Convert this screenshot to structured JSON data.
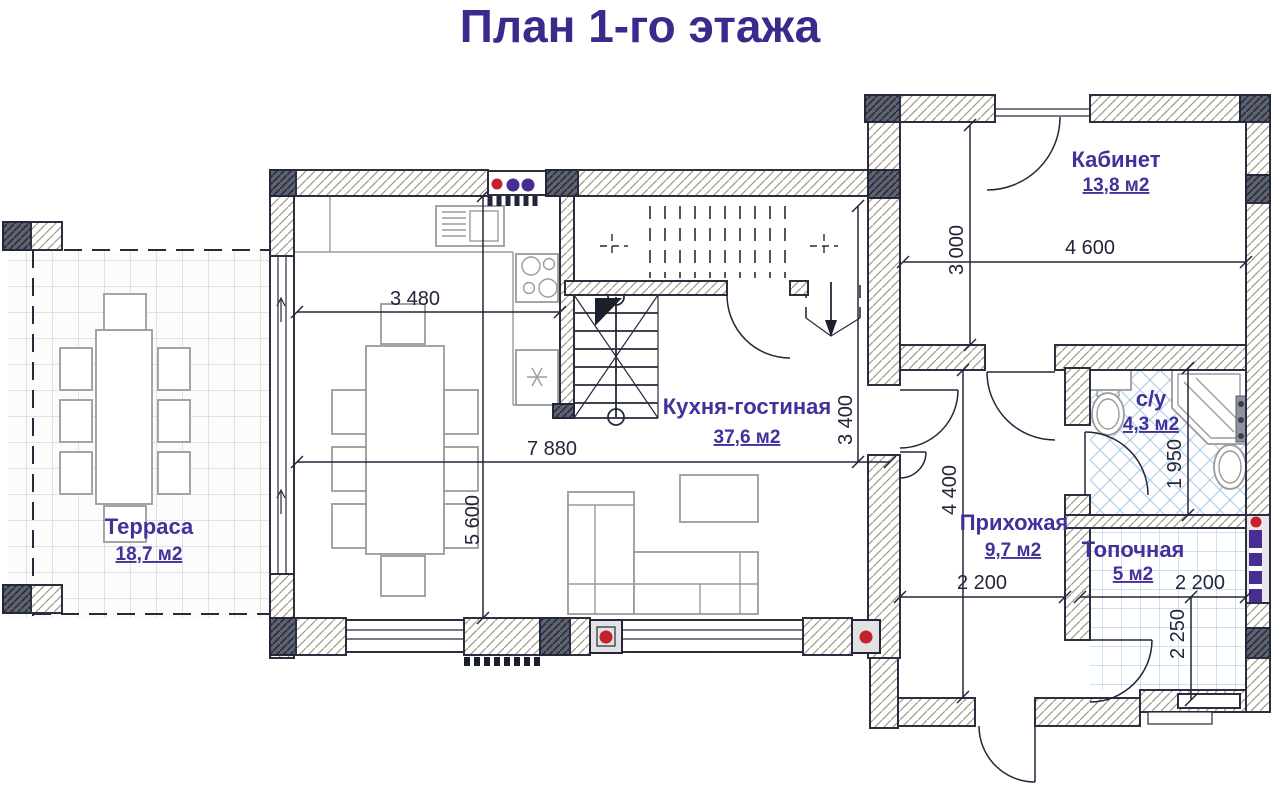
{
  "title": "План 1-го этажа",
  "rooms": {
    "terrace": {
      "name": "Терраса",
      "area": "18,7 м2"
    },
    "kitchen_living": {
      "name": "Кухня-гостиная",
      "area": "37,6 м2"
    },
    "office": {
      "name": "Кабинет",
      "area": "13,8 м2"
    },
    "bathroom": {
      "name": "с/у",
      "area": "4,3 м2"
    },
    "hallway": {
      "name": "Прихожая",
      "area": "9,7 м2"
    },
    "boiler": {
      "name": "Топочная",
      "area": "5 м2"
    }
  },
  "dimensions": {
    "kitchen_width": "3 480",
    "living_total_width": "7 880",
    "living_height": "5 600",
    "kitchen_depth": "3 400",
    "office_depth": "3 000",
    "office_width": "4 600",
    "bathroom_depth": "1 950",
    "hallway_depth": "4 400",
    "hallway_width": "2 200",
    "boiler_width": "2 200",
    "boiler_depth": "2 250"
  },
  "colors": {
    "title_text": "#3b2a8c",
    "room_label_text": "#44309a",
    "dimension_text": "#23263a",
    "wall_outline": "#2b2f40",
    "tile_blue": "#aecfe8",
    "radiator_red": "#c5202b",
    "riser_purple": "#4a2d92"
  }
}
